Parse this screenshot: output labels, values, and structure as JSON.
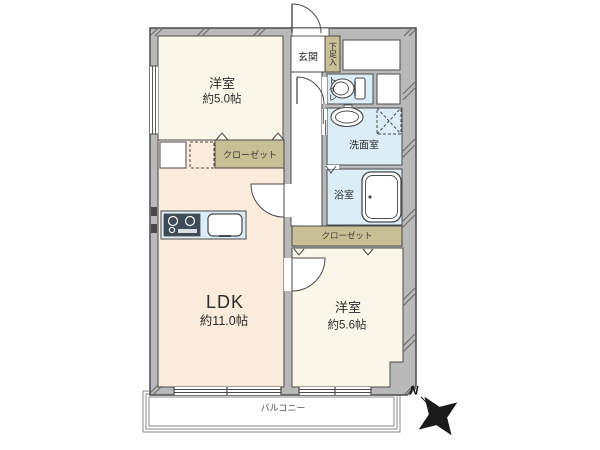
{
  "plan_title": "2LDK apartment floor plan",
  "rooms": {
    "bedroom1": {
      "name": "洋室",
      "size": "約5.0帖"
    },
    "ldk": {
      "name": "LDK",
      "size": "約11.0帖"
    },
    "bedroom2": {
      "name": "洋室",
      "size": "約5.6帖"
    },
    "entrance": {
      "name": "玄関"
    },
    "shoe_cabinet": {
      "name": "下足入"
    },
    "toilet": {
      "name": "トイレ"
    },
    "washroom": {
      "name": "洗面室"
    },
    "bathroom": {
      "name": "浴室"
    },
    "closet_front": {
      "name": "クローゼット"
    },
    "closet_back": {
      "name": "クローゼット"
    },
    "balcony": {
      "name": "バルコニー"
    }
  },
  "compass": {
    "north_label": "N"
  },
  "colors": {
    "wall_fill": "#b9b9b9",
    "wall_line": "#4a4a4a",
    "bedroom_floor": "#faf7e8",
    "ldk_floor": "#fbebdb",
    "wet_area_floor": "#dbedf6",
    "closet_fill": "#c9bf94",
    "hall_fill": "#ffffff",
    "counter_fill": "#dbedf6",
    "stove_fill": "#3e4c59",
    "compass_fill": "#1a1a1a",
    "balcony_line": "#8a8a8a"
  }
}
